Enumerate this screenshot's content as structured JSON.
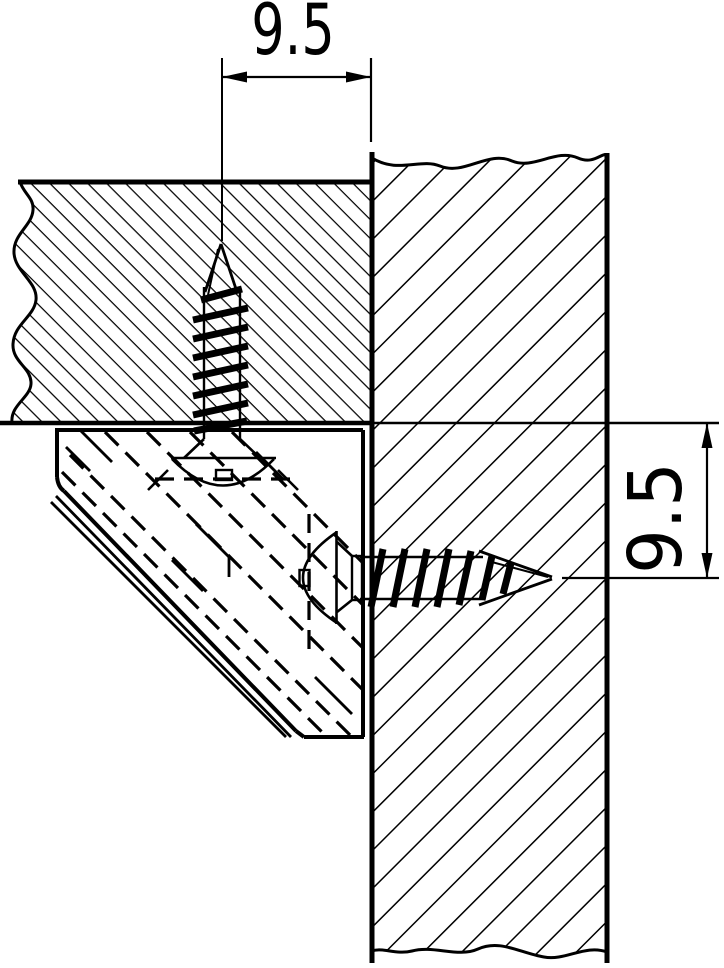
{
  "page": {
    "background": "#ffffff",
    "line_color": "#000000"
  },
  "dimensions": {
    "top": {
      "value": "9.5"
    },
    "right": {
      "value": "9.5"
    }
  }
}
